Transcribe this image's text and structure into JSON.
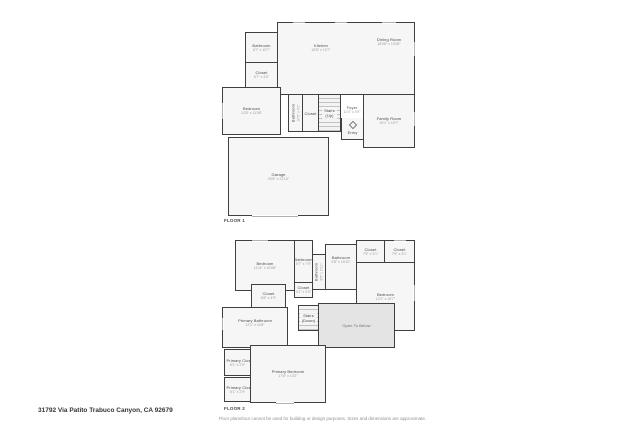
{
  "colors": {
    "wall": "#3f3f3f",
    "room_fill": "#f6f6f6",
    "open_to_below_fill": "#e4e4e4",
    "room_name_text": "#4a4a4a",
    "dim_text": "#9b9b9b"
  },
  "footer": {
    "address": "31792 Via Patito Trabuco Canyon, CA 92679",
    "disclaimer": "Floor plans/tour cannot be used for building or design purposes. Sizes and dimensions are approximate."
  },
  "floor1": {
    "label": "FLOOR 1",
    "rooms": {
      "bathroom": {
        "name": "Bathroom",
        "dims": "6'7\" x 10'7\""
      },
      "closet_hall": {
        "name": "Closet",
        "dims": "6'7\" x 4'0\""
      },
      "kitchen": {
        "name": "Kitchen",
        "dims": "18'8\" x 13'7\""
      },
      "dining": {
        "name": "Dining Room",
        "dims": "18'08\" x 13'08\""
      },
      "bedroom": {
        "name": "Bedroom",
        "dims": "12'8\" x 11'08\""
      },
      "bathroom_hall": {
        "name": "Bathroom",
        "dims": "10'5\" x 4'1\""
      },
      "closet_stairs": {
        "name": "Closet",
        "dims": ""
      },
      "stairs": {
        "name": "Stairs",
        "dims": "(Up)"
      },
      "foyer": {
        "name": "Foyer",
        "dims": "11'4\" x 4'9\""
      },
      "family": {
        "name": "Family Room",
        "dims": "16'1\" x 15'7\""
      },
      "entry": {
        "name": "Entry",
        "dims": ""
      },
      "garage": {
        "name": "Garage",
        "dims": "20'8\" x 21'10\""
      }
    }
  },
  "floor2": {
    "label": "FLOOR 2",
    "rooms": {
      "bedroom_left": {
        "name": "Bedroom",
        "dims": "11'11\" x 10'08\""
      },
      "bathroom_top": {
        "name": "Bathroom",
        "dims": "5'7\" x 7'9\""
      },
      "closet_hall": {
        "name": "Closet",
        "dims": "4'1\" x 2'9\""
      },
      "bathroom_mid": {
        "name": "Bathroom",
        "dims": "8'5\" x 2'11\""
      },
      "bathroom_center": {
        "name": "Bathroom",
        "dims": "9'8\" x 10'10\""
      },
      "closet_tr1": {
        "name": "Closet",
        "dims": "7'5\" x 3'1\""
      },
      "closet_tr2": {
        "name": "Closet",
        "dims": "7'5\" x 3'1\""
      },
      "bedroom_right": {
        "name": "Bedroom",
        "dims": "12'1\" x 10'7\""
      },
      "closet_left": {
        "name": "Closet",
        "dims": "8'8\" x 4'9\""
      },
      "primary_bathroom": {
        "name": "Primary Bathroom",
        "dims": "12'1\" x 10'8\""
      },
      "stairs": {
        "name": "Stairs",
        "dims": "(Down)"
      },
      "open_below": {
        "name": "Open To Below",
        "dims": ""
      },
      "primary_closet1": {
        "name": "Primary Closet",
        "dims": "5'1\" x 2'9\""
      },
      "primary_closet2": {
        "name": "Primary Closet",
        "dims": "5'1\" x 2'9\""
      },
      "primary_bedroom": {
        "name": "Primary Bedroom",
        "dims": "17'8\" x 13'2\""
      }
    }
  }
}
